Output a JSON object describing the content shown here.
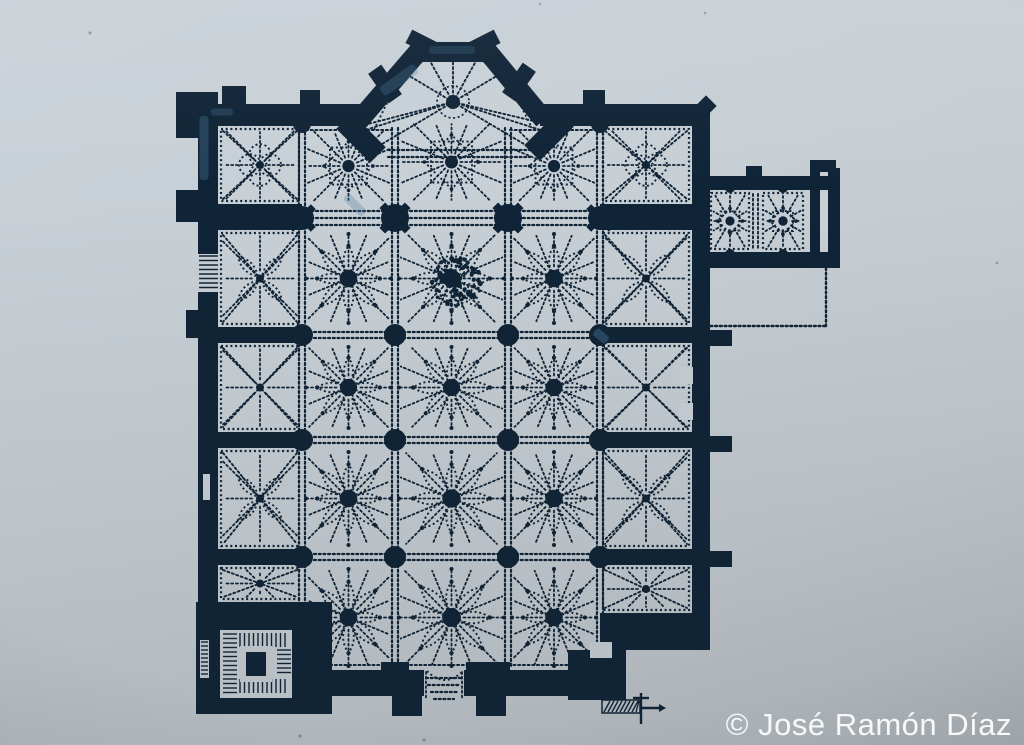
{
  "meta": {
    "watermark": "© José Ramón Díaz",
    "watermark_color": "#f6f8f9",
    "ink": "#102437",
    "paper": "#c9d0d5",
    "highlight": "#4f7ea3",
    "background_top": "#cad2d9",
    "background_bottom": "#b6bcc0",
    "subject": "gothic-cathedral-floor-plan"
  },
  "plan": {
    "walls": [
      [
        176,
        92,
        26,
        46
      ],
      [
        198,
        92,
        20,
        510
      ],
      [
        198,
        104,
        166,
        22
      ],
      [
        540,
        104,
        154,
        22
      ],
      [
        692,
        104,
        18,
        512
      ],
      [
        222,
        86,
        24,
        20
      ],
      [
        300,
        90,
        20,
        16
      ],
      [
        583,
        90,
        22,
        16
      ],
      [
        176,
        190,
        24,
        32
      ],
      [
        186,
        310,
        14,
        28
      ],
      [
        710,
        330,
        22,
        16
      ],
      [
        710,
        436,
        22,
        16
      ],
      [
        710,
        551,
        22,
        16
      ],
      [
        218,
        204,
        84,
        26
      ],
      [
        600,
        204,
        92,
        26
      ],
      [
        218,
        327,
        84,
        16
      ],
      [
        218,
        432,
        84,
        16
      ],
      [
        218,
        549,
        84,
        16
      ],
      [
        600,
        327,
        92,
        16
      ],
      [
        600,
        432,
        92,
        16
      ],
      [
        600,
        549,
        92,
        16
      ],
      [
        600,
        613,
        110,
        37
      ],
      [
        568,
        650,
        58,
        50
      ],
      [
        332,
        670,
        92,
        26
      ],
      [
        464,
        670,
        142,
        26
      ],
      [
        466,
        662,
        44,
        34
      ],
      [
        392,
        696,
        30,
        20
      ],
      [
        476,
        696,
        30,
        20
      ],
      [
        196,
        602,
        136,
        112
      ],
      [
        694,
        176,
        146,
        14
      ],
      [
        694,
        252,
        146,
        16
      ],
      [
        810,
        170,
        10,
        98
      ],
      [
        828,
        168,
        12,
        100
      ],
      [
        746,
        166,
        16,
        12
      ],
      [
        810,
        160,
        26,
        12
      ]
    ],
    "rotWalls": [
      [
        424,
        44,
        34,
        15,
        27
      ],
      [
        482,
        44,
        34,
        15,
        -27
      ],
      [
        385,
        84,
        36,
        16,
        55
      ],
      [
        519,
        82,
        36,
        16,
        -55
      ],
      [
        700,
        112,
        32,
        15,
        -45
      ],
      [
        361,
        138,
        48,
        22,
        45
      ],
      [
        549,
        136,
        48,
        22,
        -45
      ]
    ],
    "apse": {
      "outline": [
        [
          356,
          124
        ],
        [
          418,
          52
        ],
        [
          488,
          52
        ],
        [
          544,
          120
        ]
      ],
      "thickness": 20,
      "boss": [
        453,
        102
      ],
      "rays": [
        [
          368,
          124
        ],
        [
          396,
          68
        ],
        [
          426,
          54
        ],
        [
          453,
          48
        ],
        [
          480,
          54
        ],
        [
          510,
          68
        ],
        [
          538,
          122
        ],
        [
          382,
          144
        ],
        [
          524,
          144
        ],
        [
          353,
          134
        ],
        [
          553,
          134
        ]
      ],
      "inner": [
        [
          374,
          130
        ],
        [
          402,
          72
        ],
        [
          430,
          58
        ],
        [
          476,
          58
        ],
        [
          504,
          72
        ],
        [
          532,
          128
        ]
      ]
    },
    "grid": {
      "cols": [
        302,
        395,
        508,
        600
      ],
      "colY": [
        128,
        666
      ],
      "rows": [
        335,
        440,
        557
      ],
      "rowX": [
        220,
        690
      ],
      "choirBandY": [
        211,
        218,
        225
      ],
      "choirBandX": [
        302,
        600
      ],
      "mouthBandY": [
        150,
        157
      ],
      "mouthBandX": [
        388,
        530
      ],
      "topSegs": [
        [
          306,
          130,
          392,
          130
        ],
        [
          510,
          130,
          596,
          130
        ]
      ],
      "bottomSeg": [
        302,
        665,
        600,
        665
      ]
    },
    "bays": [
      {
        "x": 218,
        "y": 126,
        "w": 84,
        "h": 78,
        "t": "quatrefoil"
      },
      {
        "x": 302,
        "y": 126,
        "w": 93,
        "h": 80,
        "t": "star8"
      },
      {
        "x": 395,
        "y": 118,
        "w": 113,
        "h": 88,
        "t": "star8"
      },
      {
        "x": 508,
        "y": 126,
        "w": 92,
        "h": 80,
        "t": "star8"
      },
      {
        "x": 600,
        "y": 126,
        "w": 92,
        "h": 78,
        "t": "quatrefoil"
      },
      {
        "x": 218,
        "y": 230,
        "w": 84,
        "h": 97,
        "t": "flower4"
      },
      {
        "x": 302,
        "y": 230,
        "w": 93,
        "h": 97,
        "t": "flower"
      },
      {
        "x": 395,
        "y": 230,
        "w": 113,
        "h": 97,
        "t": "flower"
      },
      {
        "x": 508,
        "y": 230,
        "w": 92,
        "h": 97,
        "t": "flower"
      },
      {
        "x": 600,
        "y": 230,
        "w": 92,
        "h": 97,
        "t": "flower4"
      },
      {
        "x": 218,
        "y": 343,
        "w": 84,
        "h": 89,
        "t": "chapelX"
      },
      {
        "x": 302,
        "y": 343,
        "w": 93,
        "h": 89,
        "t": "flower"
      },
      {
        "x": 395,
        "y": 343,
        "w": 113,
        "h": 89,
        "t": "flower"
      },
      {
        "x": 508,
        "y": 343,
        "w": 92,
        "h": 89,
        "t": "flower"
      },
      {
        "x": 600,
        "y": 343,
        "w": 92,
        "h": 89,
        "t": "chapelX"
      },
      {
        "x": 218,
        "y": 448,
        "w": 84,
        "h": 101,
        "t": "flower4"
      },
      {
        "x": 302,
        "y": 448,
        "w": 93,
        "h": 101,
        "t": "flower"
      },
      {
        "x": 395,
        "y": 448,
        "w": 113,
        "h": 101,
        "t": "flower"
      },
      {
        "x": 508,
        "y": 448,
        "w": 92,
        "h": 101,
        "t": "flower"
      },
      {
        "x": 600,
        "y": 448,
        "w": 92,
        "h": 101,
        "t": "flower4"
      },
      {
        "x": 218,
        "y": 565,
        "w": 84,
        "h": 37,
        "t": "chapelX"
      },
      {
        "x": 302,
        "y": 565,
        "w": 93,
        "h": 105,
        "t": "flower"
      },
      {
        "x": 395,
        "y": 565,
        "w": 113,
        "h": 105,
        "t": "flower"
      },
      {
        "x": 508,
        "y": 565,
        "w": 92,
        "h": 105,
        "t": "flower"
      },
      {
        "x": 600,
        "y": 565,
        "w": 92,
        "h": 48,
        "t": "chapelX"
      },
      {
        "x": 708,
        "y": 190,
        "w": 44,
        "h": 62,
        "t": "star8s"
      },
      {
        "x": 760,
        "y": 190,
        "w": 46,
        "h": 62,
        "t": "star8s"
      }
    ],
    "piers": {
      "big": [
        [
          395,
          218
        ],
        [
          508,
          218
        ]
      ],
      "chapelBig": [
        [
          302,
          218
        ],
        [
          600,
          218
        ]
      ],
      "round": [
        [
          302,
          335
        ],
        [
          395,
          335
        ],
        [
          508,
          335
        ],
        [
          600,
          335
        ],
        [
          302,
          440
        ],
        [
          395,
          440
        ],
        [
          508,
          440
        ],
        [
          600,
          440
        ],
        [
          302,
          557
        ],
        [
          395,
          557
        ],
        [
          508,
          557
        ],
        [
          600,
          557
        ]
      ],
      "topResponds": [
        [
          302,
          124
        ],
        [
          600,
          124
        ]
      ],
      "bottomRespond": [
        381,
        662,
        28,
        12
      ],
      "annexResponds": [
        [
          730,
          188
        ],
        [
          783,
          188
        ],
        [
          730,
          254
        ],
        [
          783,
          254
        ]
      ]
    },
    "door": {
      "x": 198,
      "y": 254,
      "w": 21,
      "h": 38
    },
    "slits": [
      [
        203,
        474,
        7,
        26
      ]
    ],
    "towerSlit": {
      "x": 200,
      "y": 640,
      "w": 9,
      "h": 38
    },
    "niches": [
      [
        679,
        367,
        14,
        17
      ],
      [
        679,
        403,
        14,
        17
      ],
      [
        590,
        642,
        22,
        16
      ],
      [
        820,
        192,
        8,
        56
      ]
    ],
    "stair": {
      "outer": [
        220,
        630,
        72,
        68
      ],
      "left": [
        222,
        632,
        16,
        64
      ],
      "right": [
        276,
        648,
        16,
        30
      ],
      "top": [
        238,
        632,
        52,
        16
      ],
      "bottom": [
        238,
        678,
        52,
        16
      ],
      "coreWhite": [
        240,
        646,
        32,
        36
      ],
      "core": [
        246,
        652,
        20,
        24
      ]
    },
    "portal": {
      "lines": [
        [
          426,
          678,
          462,
          678
        ],
        [
          428,
          685,
          460,
          685
        ],
        [
          431,
          692,
          457,
          692
        ],
        [
          434,
          699,
          454,
          699
        ]
      ],
      "sides": [
        [
          426,
          672,
          426,
          700
        ],
        [
          462,
          672,
          462,
          700
        ]
      ],
      "arc": "M427,671 Q445,689 463,671"
    },
    "courtyard": {
      "lines": [
        [
          701,
          270,
          701,
          318
        ],
        [
          826,
          268,
          826,
          326
        ],
        [
          701,
          326,
          826,
          326
        ]
      ]
    },
    "annexArch": [
      [
        697,
        198,
        697,
        250
      ],
      [
        704,
        198,
        704,
        250
      ]
    ],
    "annexMid": [
      [
        753,
        194,
        753,
        248
      ],
      [
        758,
        194,
        758,
        248
      ]
    ],
    "scaleBar": {
      "hatch": [
        602,
        700,
        38,
        13
      ],
      "vline": [
        641,
        693,
        641,
        724
      ],
      "tick": [
        633,
        698,
        649,
        698
      ],
      "arrow": [
        641,
        708,
        659,
        708
      ],
      "tip": [
        [
          659,
          704
        ],
        [
          666,
          708
        ],
        [
          659,
          712
        ]
      ]
    },
    "blob": {
      "cx": 456,
      "cy": 282,
      "r": 25,
      "n": 120
    },
    "specks": [
      [
        90,
        33,
        1.6
      ],
      [
        300,
        736,
        1.7
      ],
      [
        424,
        740,
        1.7
      ],
      [
        705,
        13,
        1.3
      ],
      [
        997,
        263,
        1.4
      ],
      [
        540,
        4,
        1.2
      ]
    ],
    "highlights": [
      [
        204,
        148,
        9,
        64,
        0,
        0.32
      ],
      [
        399,
        80,
        11,
        42,
        55,
        0.28
      ],
      [
        452,
        50,
        46,
        8,
        0,
        0.22
      ],
      [
        601,
        336,
        16,
        9,
        40,
        0.4
      ],
      [
        222,
        112,
        22,
        7,
        0,
        0.25
      ],
      [
        355,
        205,
        26,
        9,
        45,
        0.3
      ]
    ]
  }
}
